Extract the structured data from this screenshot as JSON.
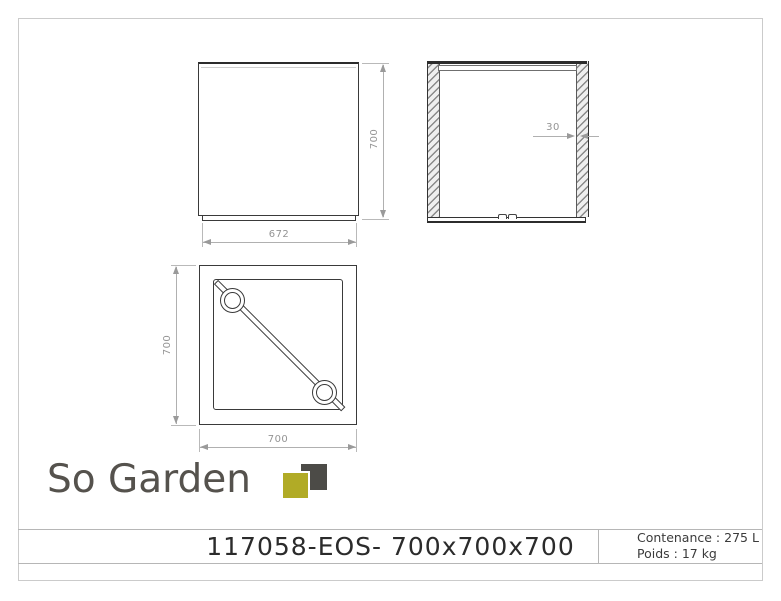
{
  "views": {
    "front": {
      "height_label": "700",
      "base_width_label": "672"
    },
    "section": {
      "wall_thickness_label": "30"
    },
    "top": {
      "height_label": "700",
      "width_label": "700"
    }
  },
  "logo": {
    "text": "So Garden",
    "text_color": "#55524d",
    "square_dark_color": "#4c4b47",
    "square_olive_color": "#b1ab26"
  },
  "title_block": {
    "reference": "117058-EOS- 700x700x700",
    "capacity": "Contenance : 275 L",
    "weight": "Poids : 17 kg"
  }
}
